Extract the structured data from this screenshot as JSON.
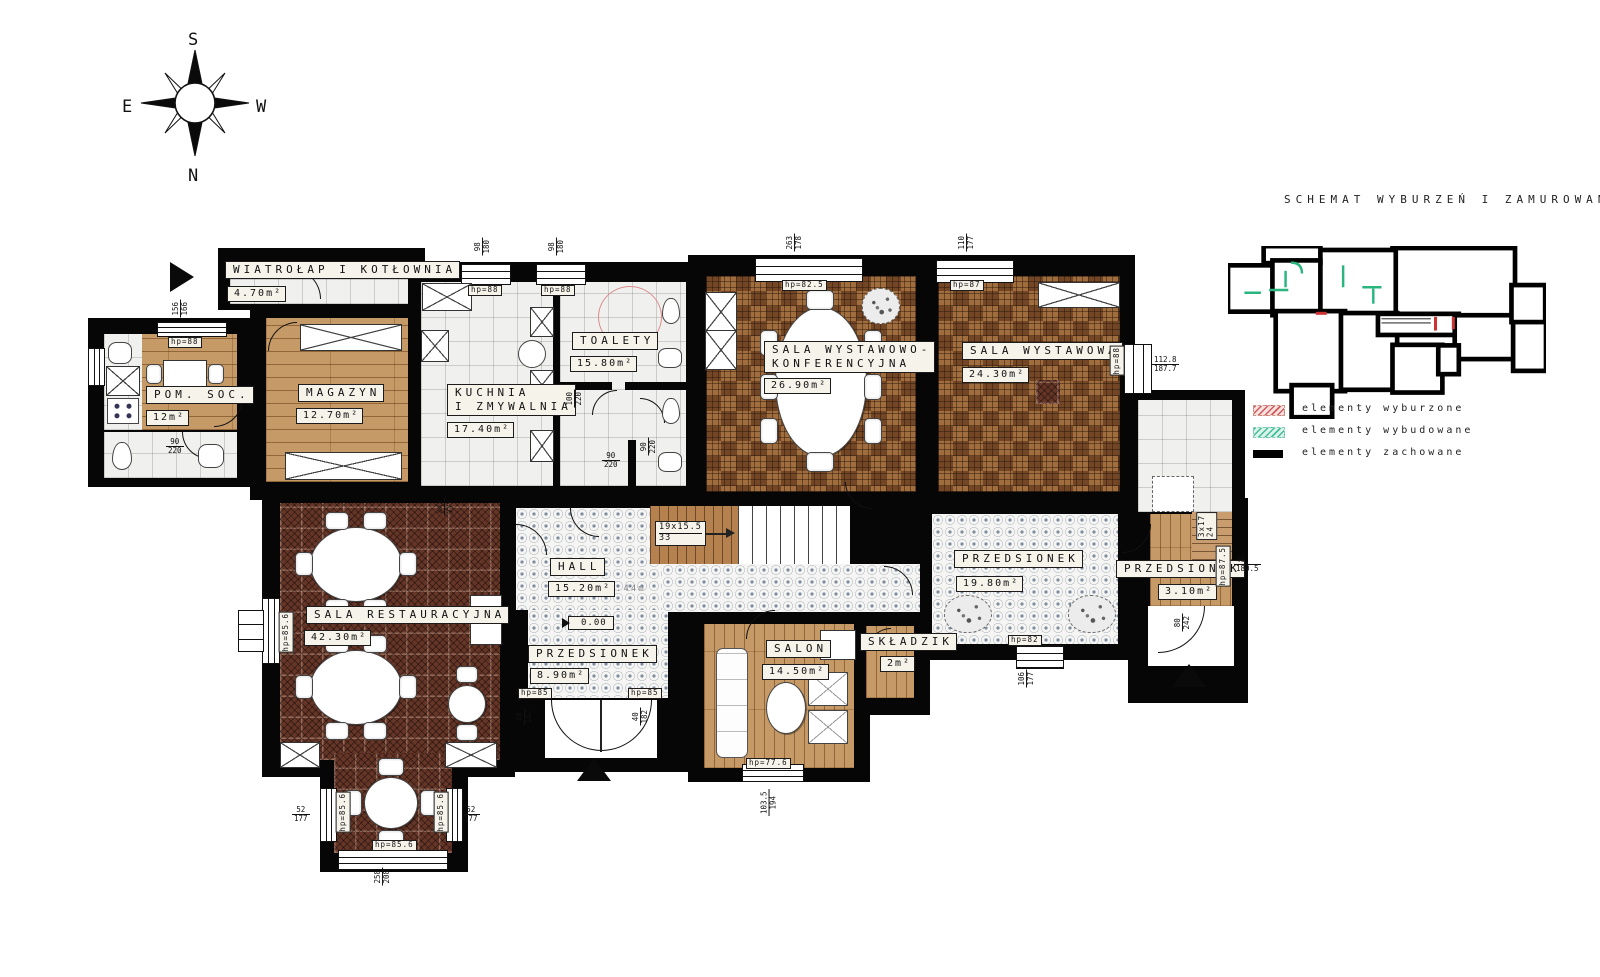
{
  "compass": {
    "top": "S",
    "bottom": "N",
    "left": "E",
    "right": "W"
  },
  "schematic": {
    "title": "SCHEMAT WYBURZEŃ I ZAMUROWAŃ",
    "legend": [
      {
        "label": "elementy wyburzone",
        "type": "red-hatch",
        "color": "#cc4444"
      },
      {
        "label": "elementy wybudowane",
        "type": "green-hatch",
        "color": "#3fbf97"
      },
      {
        "label": "elementy zachowane",
        "type": "black-solid",
        "color": "#000000"
      }
    ]
  },
  "rooms": {
    "wiatrolap": {
      "name": "WIATROŁAP I KOTŁOWNIA",
      "area": "4.70m²"
    },
    "pom_soc": {
      "name": "POM. SOC.",
      "area": "12m²"
    },
    "magazyn": {
      "name": "MAGAZYN",
      "area": "12.70m²"
    },
    "kuchnia": {
      "name_line1": "KUCHNIA",
      "name_line2": "I ZMYWALNIA",
      "area": "17.40m²"
    },
    "toalety": {
      "name": "TOALETY",
      "area": "15.80m²"
    },
    "sala_wyst_konf": {
      "name_line1": "SALA WYSTAWOWO-",
      "name_line2": "KONFERENCYJNA",
      "area": "26.90m²"
    },
    "sala_wyst": {
      "name": "SALA WYSTAWOWA",
      "area": "24.30m²"
    },
    "sala_rest": {
      "name": "SALA RESTAURACYJNA",
      "area": "42.30m²"
    },
    "hall": {
      "name": "HALL",
      "area": "15.20m²",
      "note": ".44m"
    },
    "przedsionek_main": {
      "name": "PRZEDSIONEK",
      "area": "8.90m²"
    },
    "salon": {
      "name": "SALON",
      "area": "14.50m²"
    },
    "skladzik": {
      "name": "SKŁADZIK",
      "area": "2m²"
    },
    "przedsionek_east": {
      "name": "PRZEDSIONEK",
      "area": "19.80m²"
    },
    "przedsionek_side": {
      "name": "PRZEDSIONEK",
      "area": "3.10m²"
    }
  },
  "annotations": {
    "level_marker": "0.00",
    "stairs_main": {
      "line1": "19x15.5",
      "line2": "33"
    },
    "stairs_side": {
      "line1": "3x17",
      "line2": "24"
    },
    "hp": {
      "pomsoc": "hp=88",
      "kuchnia": "hp=88",
      "toalety": "hp=88",
      "salawk": "hp=82.5",
      "salaw": "hp=87",
      "salaw_r": "hp=88",
      "rest_l": "hp=85.6",
      "bay_l": "hp=85.6",
      "bay_r": "hp=85.6",
      "bay_b": "hp=85.6",
      "entry_l": "hp=85",
      "entry_r": "hp=85",
      "salon": "hp=77.6",
      "corr": "hp=82",
      "side": "hp=87.5"
    },
    "dims": {
      "pomsoc_top": {
        "a": "156",
        "b": "166"
      },
      "kuch_top": {
        "a": "98",
        "b": "180"
      },
      "toal_top": {
        "a": "98",
        "b": "180"
      },
      "swk_top": {
        "a": "263",
        "b": "178"
      },
      "sw_top": {
        "a": "110",
        "b": "177"
      },
      "sw_right": {
        "a": "112.8",
        "b": "187.7"
      },
      "bath_door": {
        "a": "90",
        "b": "220"
      },
      "wc1": {
        "a": "100",
        "b": "220"
      },
      "wc2": {
        "a": "90",
        "b": "220"
      },
      "wc3": {
        "a": "90",
        "b": "220"
      },
      "bay_l": {
        "a": "52",
        "b": "177"
      },
      "bay_r": {
        "a": "52",
        "b": "177"
      },
      "bay_b": {
        "a": "258",
        "b": "208"
      },
      "entry_l": {
        "a": "40",
        "b": "182"
      },
      "entry_r": {
        "a": "40",
        "b": "182"
      },
      "salon_b": {
        "a": "103.5",
        "b": "194"
      },
      "corr_b": {
        "a": "106",
        "b": "177"
      },
      "side_r": {
        "a": "46",
        "b": "180.5"
      },
      "side_door": {
        "a": "80",
        "b": "242"
      },
      "rest_door": {
        "a": "xxx",
        "b": "yyy"
      }
    }
  }
}
